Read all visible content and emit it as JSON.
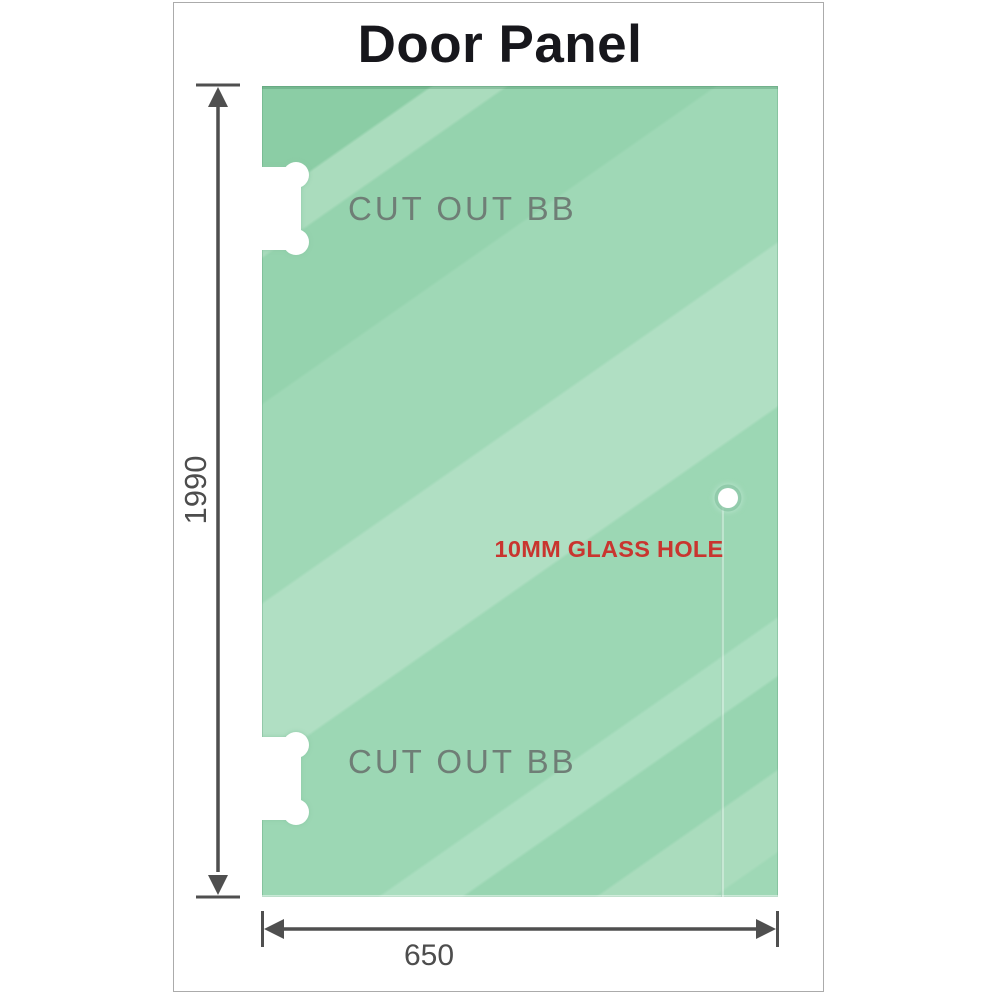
{
  "title": "Door Panel",
  "panel": {
    "cutout_top_label": "CUT OUT BB",
    "cutout_bottom_label": "CUT OUT BB",
    "glass_hole_label": "10MM GLASS HOLE"
  },
  "dimensions": {
    "height_label": "1990",
    "width_label": "650"
  },
  "colors": {
    "glass_base": "#8bcda5",
    "glass_highlight": "#b0dfc3",
    "glass_edge": "#7bc096",
    "cutout_label_gray": "#6f7e76",
    "hole_label_red": "#c9352f",
    "dimension_gray": "#4f4f4f",
    "frame_border_gray": "#ababab",
    "title_color": "#17171c"
  }
}
